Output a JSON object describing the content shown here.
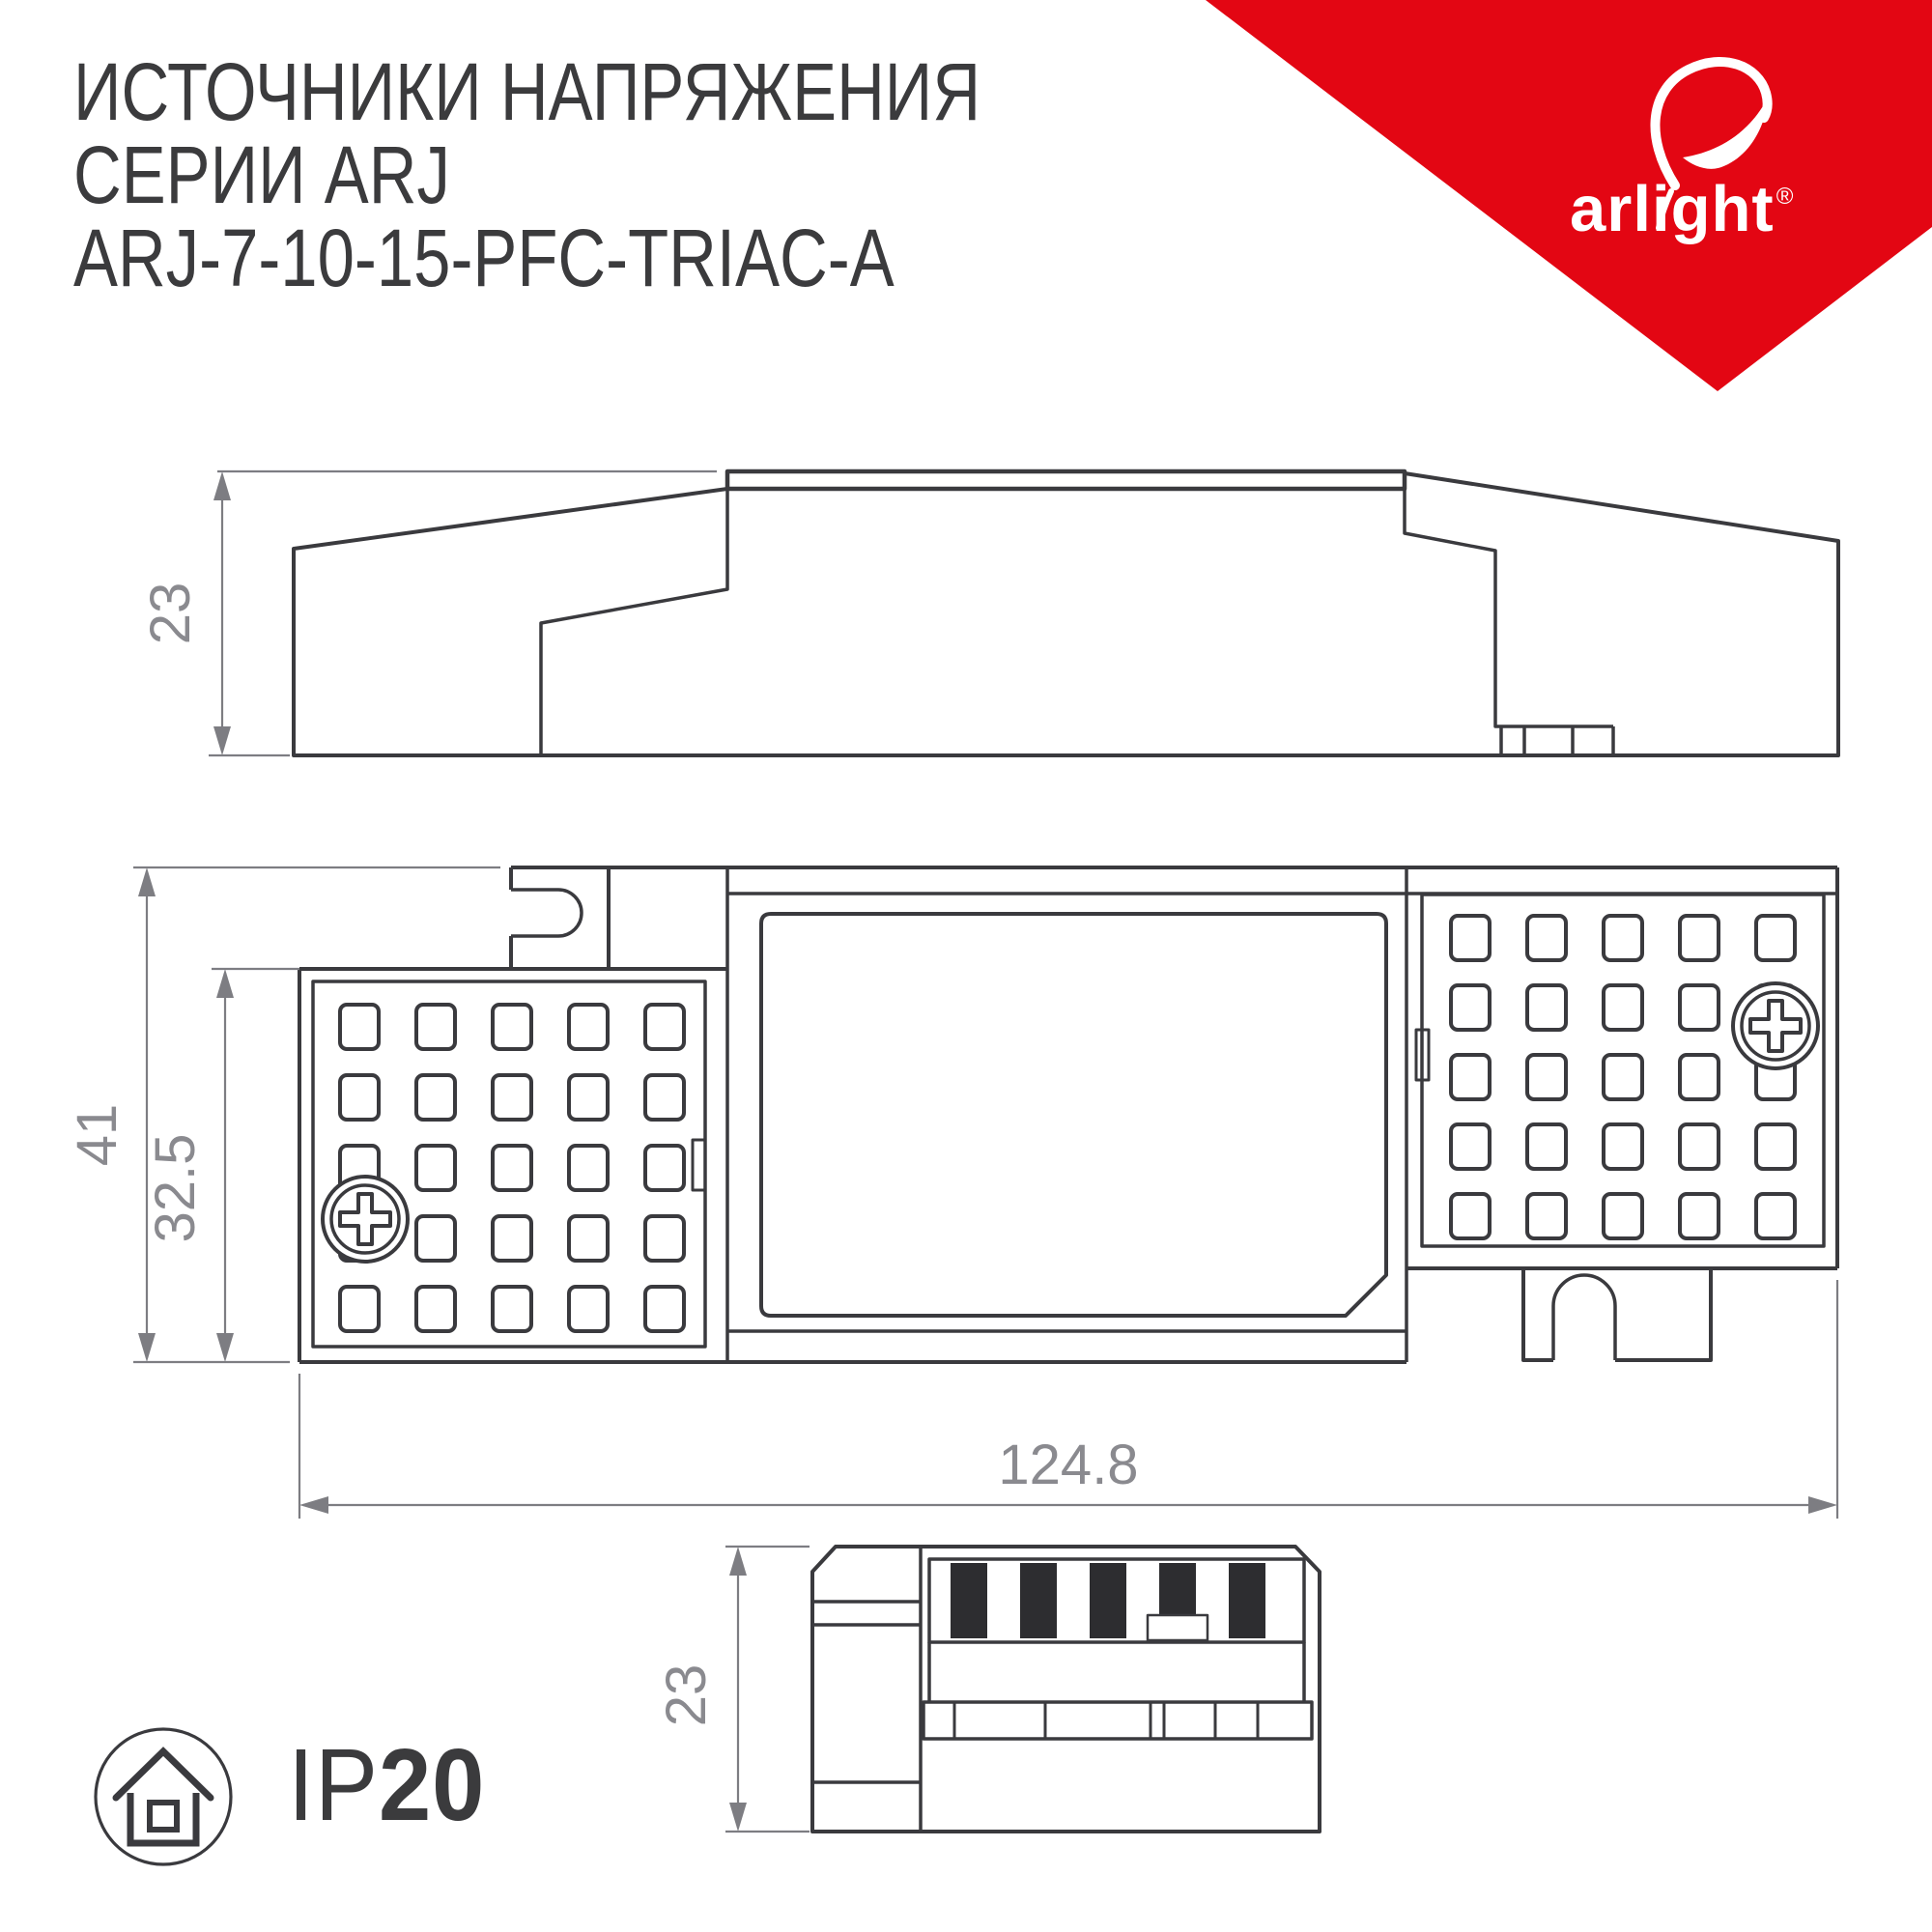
{
  "title": {
    "line1": "ИСТОЧНИКИ НАПРЯЖЕНИЯ",
    "line2": "СЕРИИ ARJ",
    "line3": "ARJ-7-10-15-PFC-TRIAC-A"
  },
  "logo": {
    "brand": "arlight",
    "registered": "®",
    "triangle_color": "#e30613",
    "icon": "arlight-swoosh-icon"
  },
  "colors": {
    "line": "#3a3a3e",
    "black_fill": "#2d2d30",
    "dim_line": "#7d7d82",
    "dim_text": "#8a8a8f",
    "background": "#ffffff"
  },
  "views": {
    "side": {
      "name": "side-view",
      "height_label": "23"
    },
    "plan": {
      "name": "top-view",
      "outer_height_label": "41",
      "inner_height_label": "32.5",
      "width_label": "124.8"
    },
    "end": {
      "name": "end-view",
      "height_label": "23"
    }
  },
  "ip_rating": {
    "prefix": "IP",
    "value": "20",
    "icon": "indoor-house-icon"
  }
}
